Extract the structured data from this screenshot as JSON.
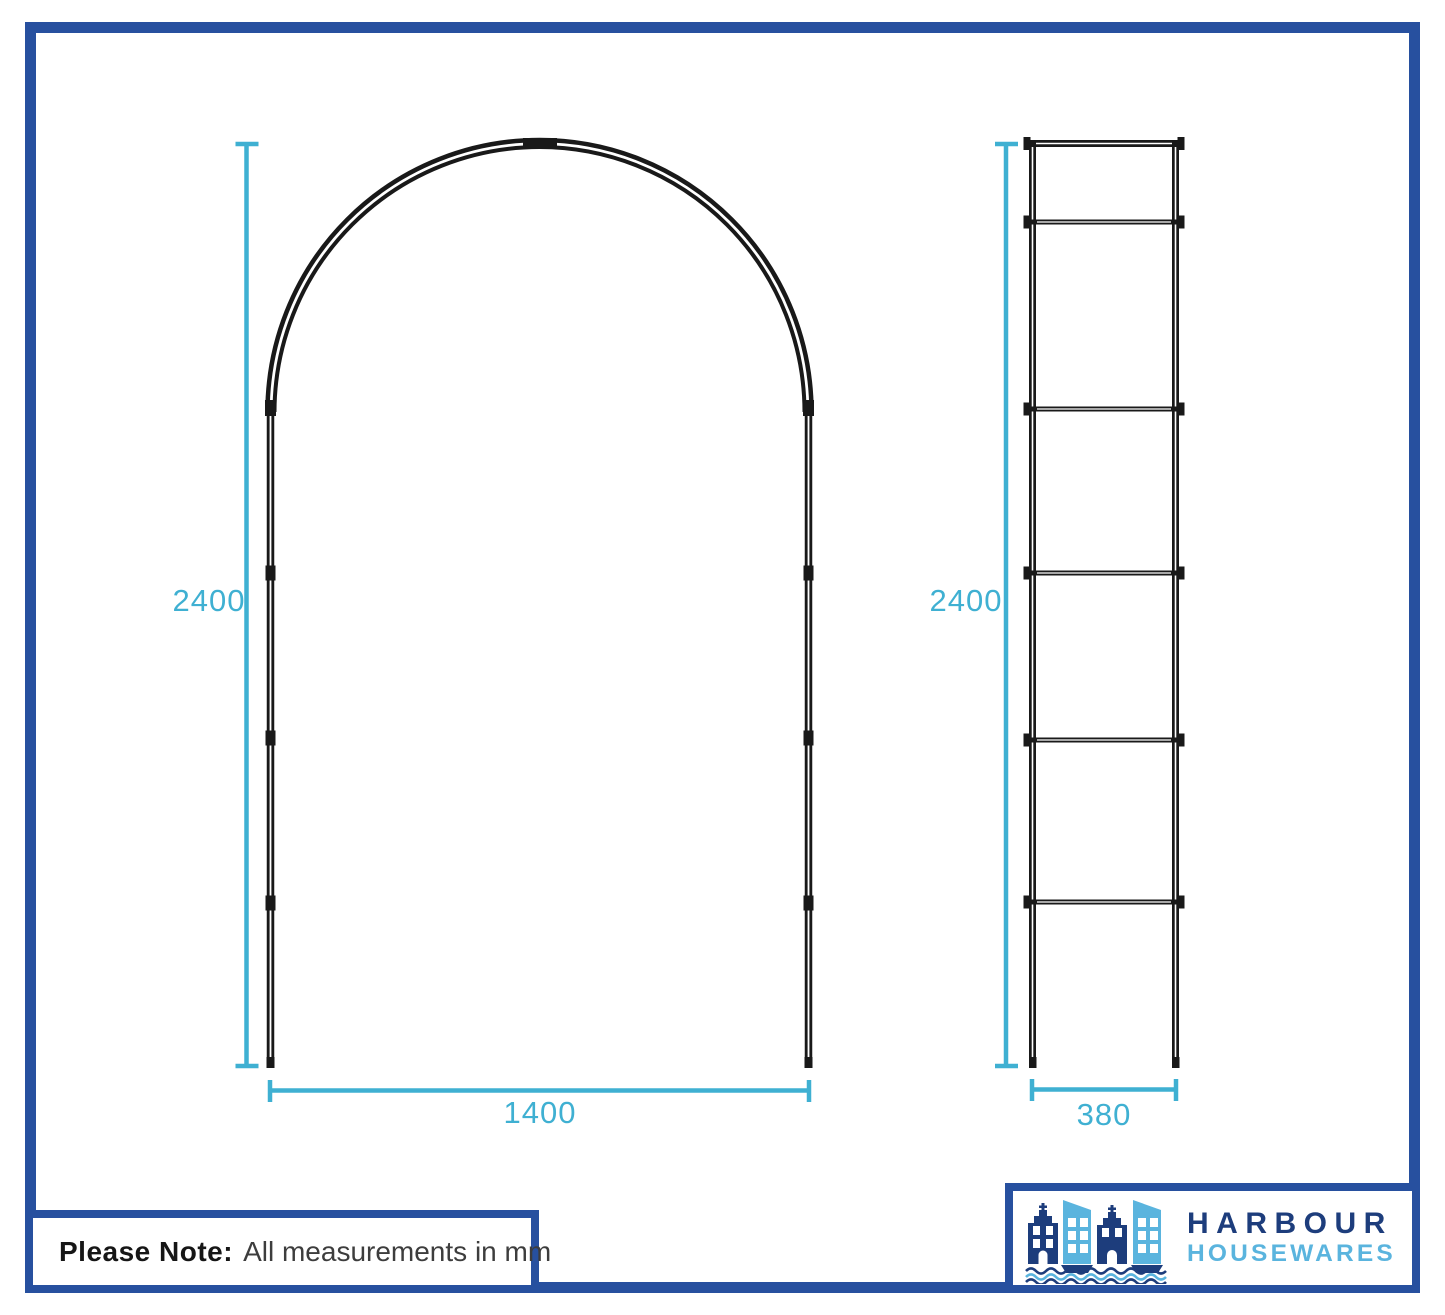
{
  "diagram": {
    "title": "Garden arch dimension drawing",
    "units": "mm",
    "front_view": {
      "name": "arch front view",
      "height_mm": "2400",
      "width_mm": "1400"
    },
    "side_view": {
      "name": "arch side view",
      "height_mm": "2400",
      "width_mm": "380"
    }
  },
  "note": {
    "label": "Please Note:",
    "text": "All measurements in mm"
  },
  "logo": {
    "brand_top": "HARBOUR",
    "brand_bottom": "HOUSEWARES"
  },
  "colors": {
    "frame_blue": "#27509f",
    "dimension_cyan": "#3fb0d2",
    "drawing_black": "#191919",
    "logo_navy": "#1d3d7c",
    "logo_light_blue": "#5ab4de"
  }
}
